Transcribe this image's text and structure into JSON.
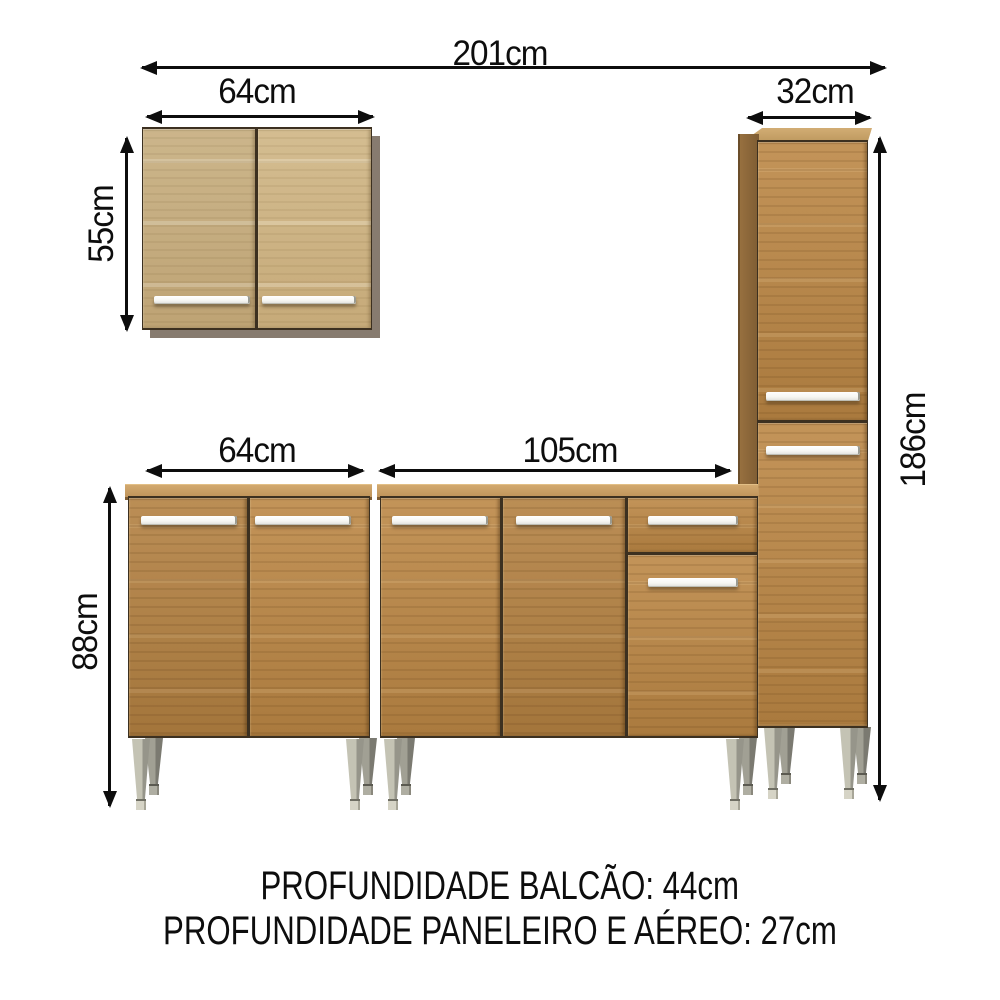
{
  "diagram": {
    "dimensions": {
      "total_width": "201cm",
      "wall_cabinet_width": "64cm",
      "tall_cabinet_width": "32cm",
      "wall_cabinet_height": "55cm",
      "base_cabinet_left_width": "64cm",
      "base_cabinet_right_width": "105cm",
      "base_cabinet_height": "88cm",
      "tall_cabinet_height": "186cm"
    },
    "notes": [
      "PROFUNDIDADE BALCÃO: 44cm",
      "PROFUNDIDADE PANELEIRO E AÉREO: 27cm"
    ],
    "colors": {
      "line": "#0d0d0d",
      "wood_light_1": "#d4bd91",
      "wood_light_2": "#c6aa79",
      "wood_honey_1": "#c39459",
      "wood_honey_2": "#aa7a3e",
      "wood_side": "#97703f",
      "counter_1": "#d2a96f",
      "counter_2": "#c0945a",
      "counter_edge": "#7c5a31",
      "shadow": "#877b6f",
      "divider": "#3c3020",
      "handle": "#f6f6f2",
      "leg_1": "#c4c3b4",
      "leg_2": "#96958a",
      "foot": "#d6d4c6"
    }
  }
}
